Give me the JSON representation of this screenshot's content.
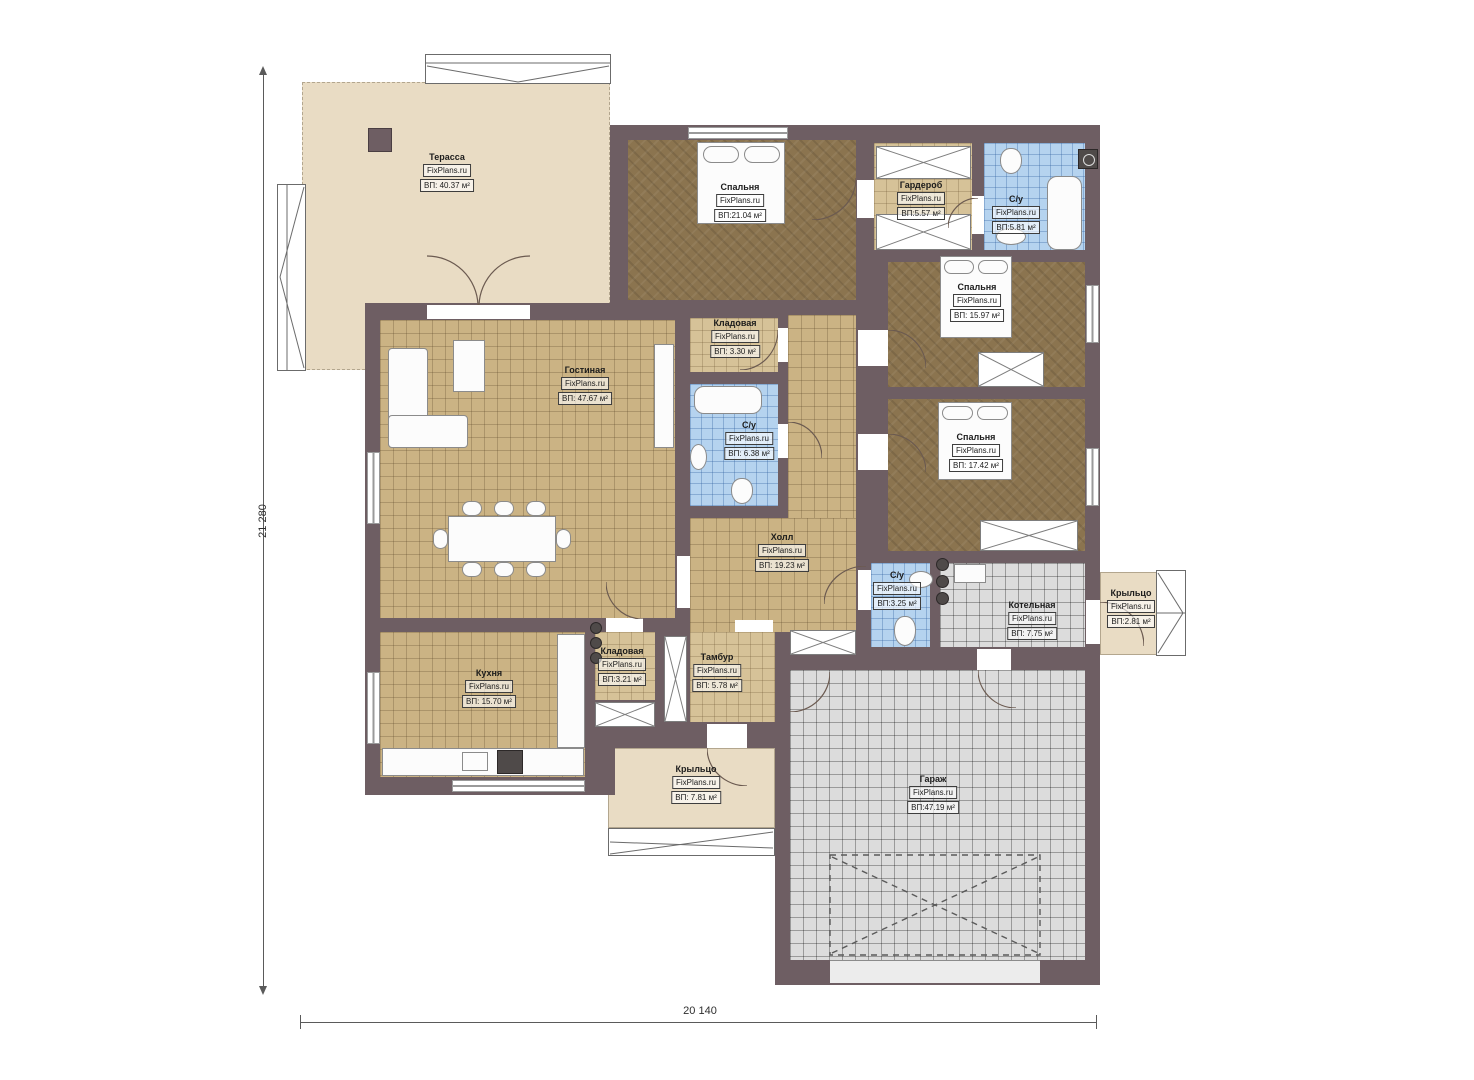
{
  "meta": {
    "brand": "FixPlans.ru",
    "wall_color": "#6e5e63",
    "outdoor_color": "#e9dcc4",
    "bath_tile_color": "#b5d3ef",
    "garage_tile_color": "#dcdcdc"
  },
  "dimensions": {
    "left": "21 280",
    "bottom": "20 140"
  },
  "rooms": [
    {
      "id": "terrace",
      "name": "Терасса",
      "area": "ВП: 40.37 м²"
    },
    {
      "id": "bedroom-1",
      "name": "Спальня",
      "area": "ВП:21.04 м²"
    },
    {
      "id": "wardrobe",
      "name": "Гардероб",
      "area": "ВП:5.57 м²"
    },
    {
      "id": "bathroom-1",
      "name": "С/у",
      "area": "ВП:5.81 м²"
    },
    {
      "id": "bedroom-2",
      "name": "Спальня",
      "area": "ВП: 15.97 м²"
    },
    {
      "id": "storage-1",
      "name": "Кладовая",
      "area": "ВП: 3.30 м²"
    },
    {
      "id": "living-room",
      "name": "Гостиная",
      "area": "ВП: 47.67 м²"
    },
    {
      "id": "bathroom-2",
      "name": "С/у",
      "area": "ВП: 6.38 м²"
    },
    {
      "id": "bedroom-3",
      "name": "Спальня",
      "area": "ВП: 17.42 м²"
    },
    {
      "id": "hall",
      "name": "Холл",
      "area": "ВП: 19.23 м²"
    },
    {
      "id": "bathroom-3",
      "name": "С/у",
      "area": "ВП:3.25 м²"
    },
    {
      "id": "boiler-room",
      "name": "Котельная",
      "area": "ВП: 7.75 м²"
    },
    {
      "id": "porch-right",
      "name": "Крыльцо",
      "area": "ВП:2.81 м²"
    },
    {
      "id": "kitchen",
      "name": "Кухня",
      "area": "ВП: 15.70 м²"
    },
    {
      "id": "storage-2",
      "name": "Кладовая",
      "area": "ВП:3.21 м²"
    },
    {
      "id": "vestibule",
      "name": "Тамбур",
      "area": "ВП: 5.78 м²"
    },
    {
      "id": "porch-bottom",
      "name": "Крыльцо",
      "area": "ВП: 7.81 м²"
    },
    {
      "id": "garage",
      "name": "Гараж",
      "area": "ВП:47.19 м²"
    }
  ]
}
